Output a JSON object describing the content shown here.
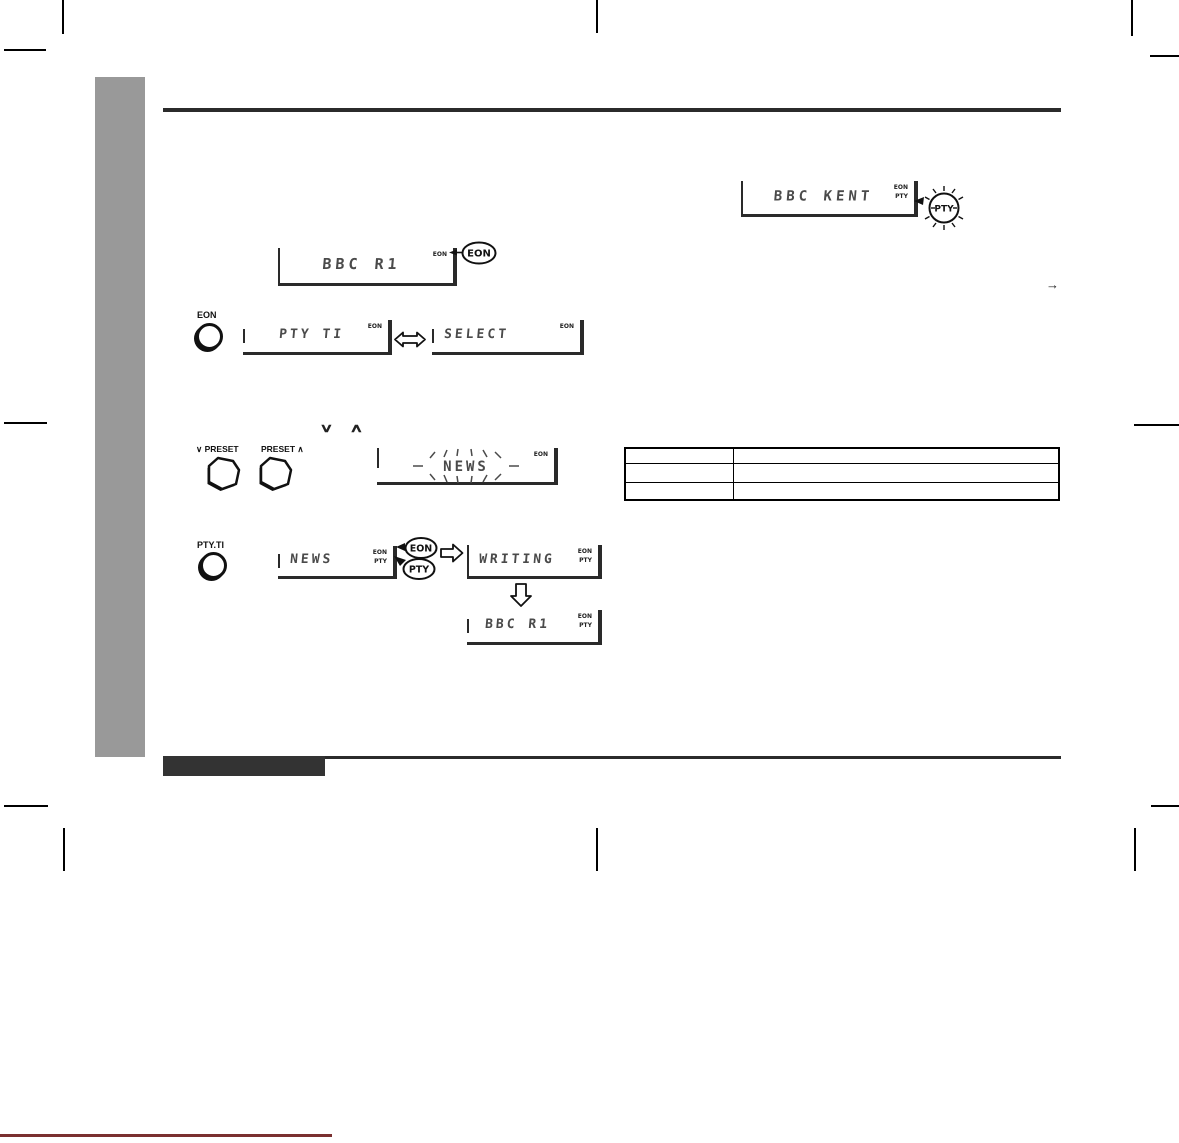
{
  "doc": {
    "kind": "tuner manual page - EON PTY operation figures"
  },
  "colors": {
    "sidebar": "#999999",
    "rule": "#2b2b2b",
    "lcd_text": "#4a4a4a",
    "footer_bar": "#333333",
    "page_edge_line": "#7a3030"
  },
  "icons": {
    "swap_arrow": "hollow-double-arrow",
    "next_arrow": "hollow-right-arrow",
    "result_arrow": "hollow-down-arrow",
    "continue_arrow": "→",
    "chevron_down": "∨",
    "chevron_up": "∧"
  },
  "steps": {
    "tune": {
      "display_text": "BBC R1",
      "indicator": "EON",
      "balloon": "EON"
    },
    "pty_detect": {
      "display_text": "BBC KENT",
      "indicators": [
        "EON",
        "PTY"
      ],
      "balloon": "PTY"
    },
    "eon_mode": {
      "button": "EON",
      "display_a": "PTY TI",
      "display_b": "SELECT",
      "indicator": "EON"
    },
    "preset_select": {
      "button_down_label": "PRESET",
      "button_up_label": "PRESET",
      "display_text": "NEWS",
      "indicator": "EON"
    },
    "confirm": {
      "button": "PTY.TI",
      "display_a": "NEWS",
      "display_b": "WRITING",
      "display_c": "BBC R1",
      "indicators": [
        "EON",
        "PTY"
      ],
      "balloon_a": "EON",
      "balloon_b": "PTY"
    }
  },
  "table": {
    "rows": [
      [
        "",
        ""
      ],
      [
        "",
        ""
      ],
      [
        "",
        ""
      ]
    ]
  }
}
